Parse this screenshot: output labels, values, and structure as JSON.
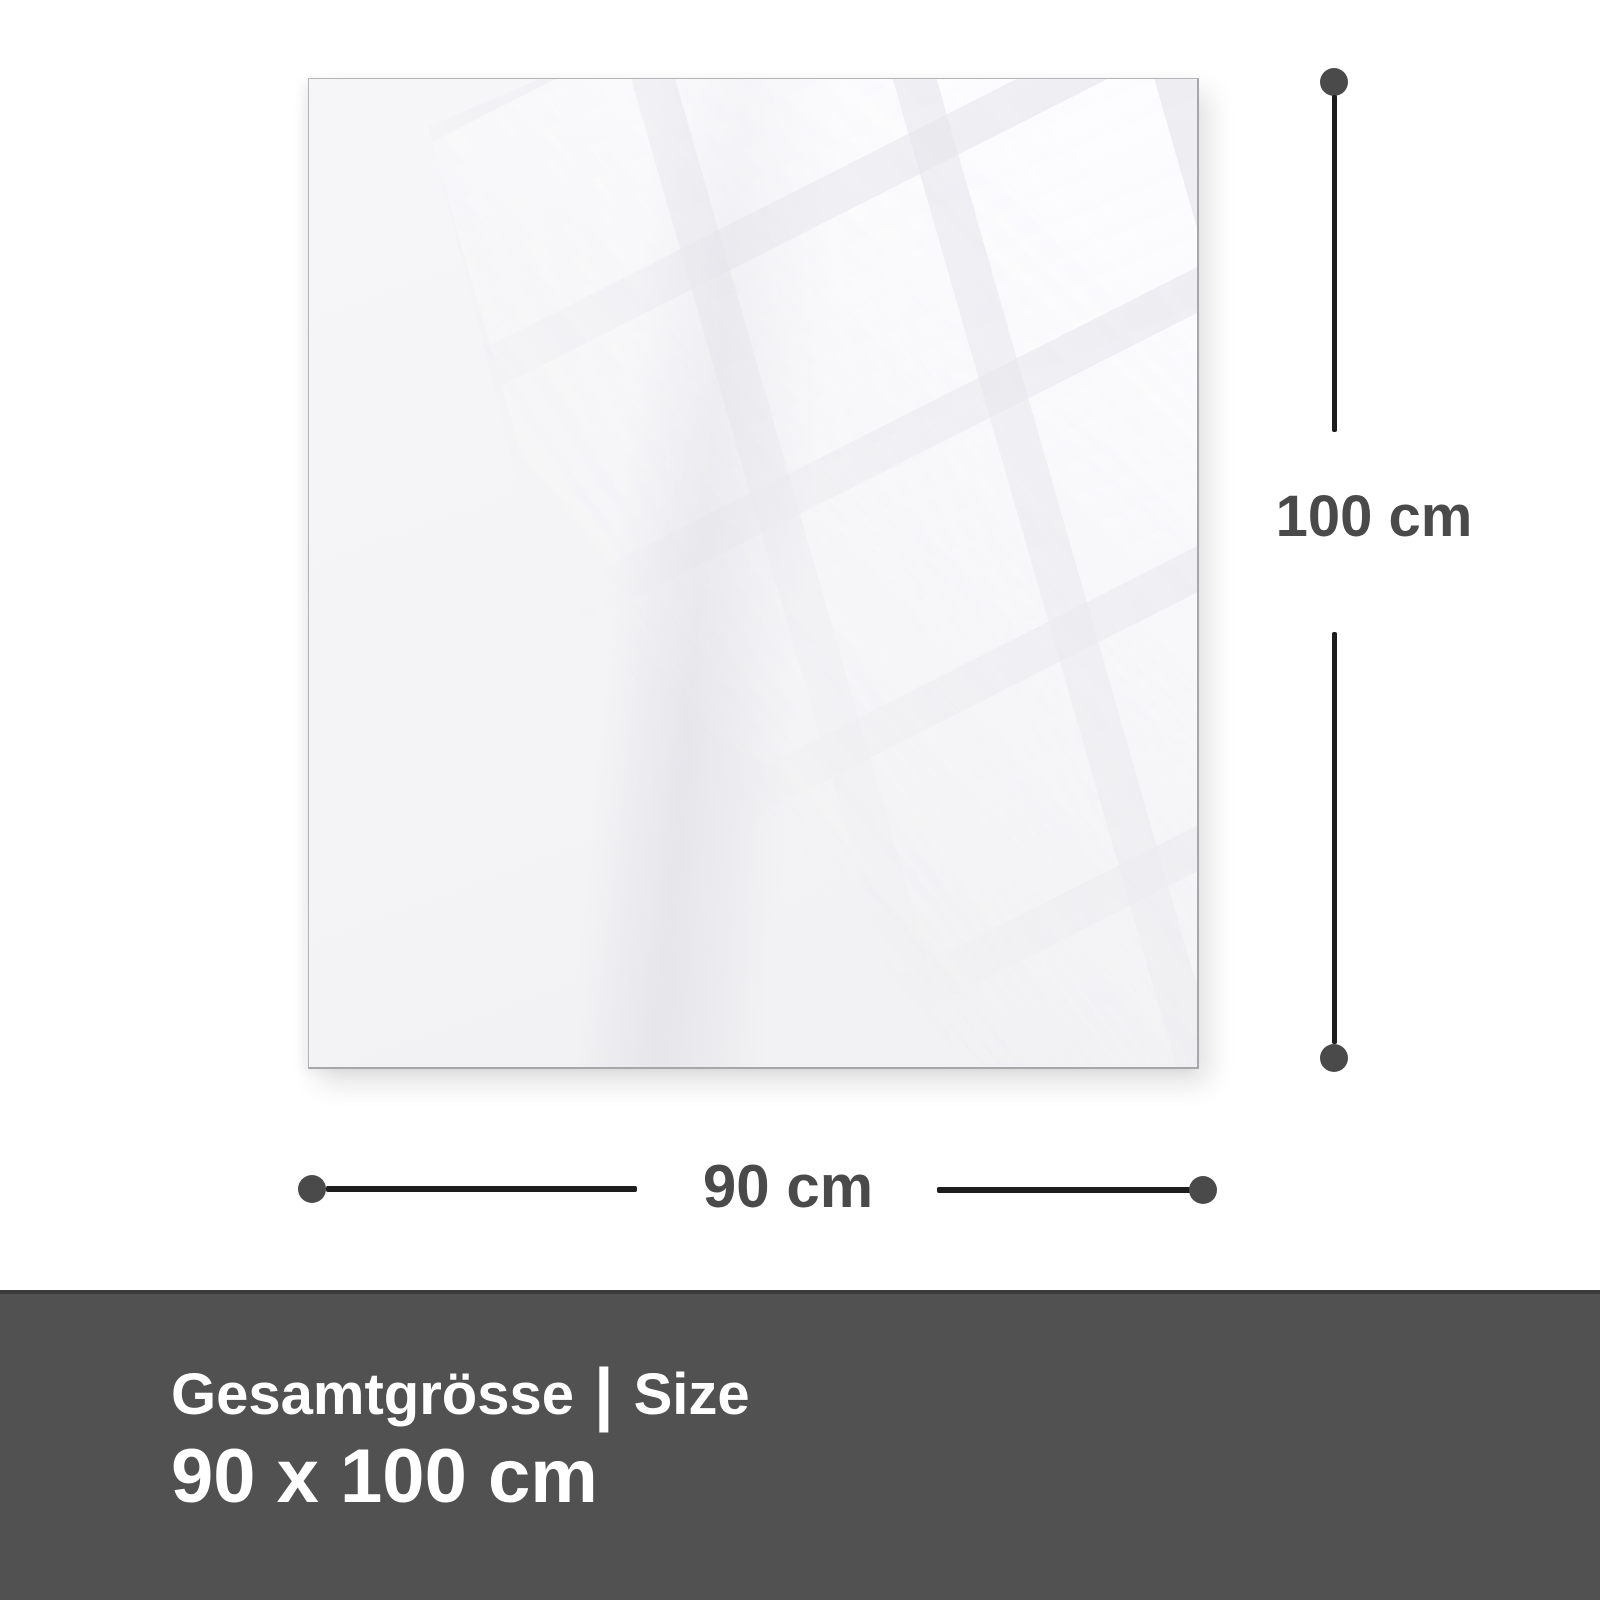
{
  "diagram": {
    "panel": {
      "name": "glass-panel"
    },
    "vertical_dimension": {
      "label": "100 cm"
    },
    "horizontal_dimension": {
      "label": "90 cm"
    },
    "footer": {
      "title_de": "Gesamtgrösse",
      "separator": "|",
      "title_en": "Size",
      "size_value": "90 x 100 cm"
    }
  },
  "colors": {
    "accent_line": "#1d1d1d",
    "dot": "#4a4a4a",
    "label_text": "#4a4a4a",
    "footer_bg": "#515151",
    "footer_border": "#3b3b3b",
    "footer_text": "#ffffff",
    "panel_fill": "#f4f4f6",
    "panel_border": "#b5b5b7"
  }
}
